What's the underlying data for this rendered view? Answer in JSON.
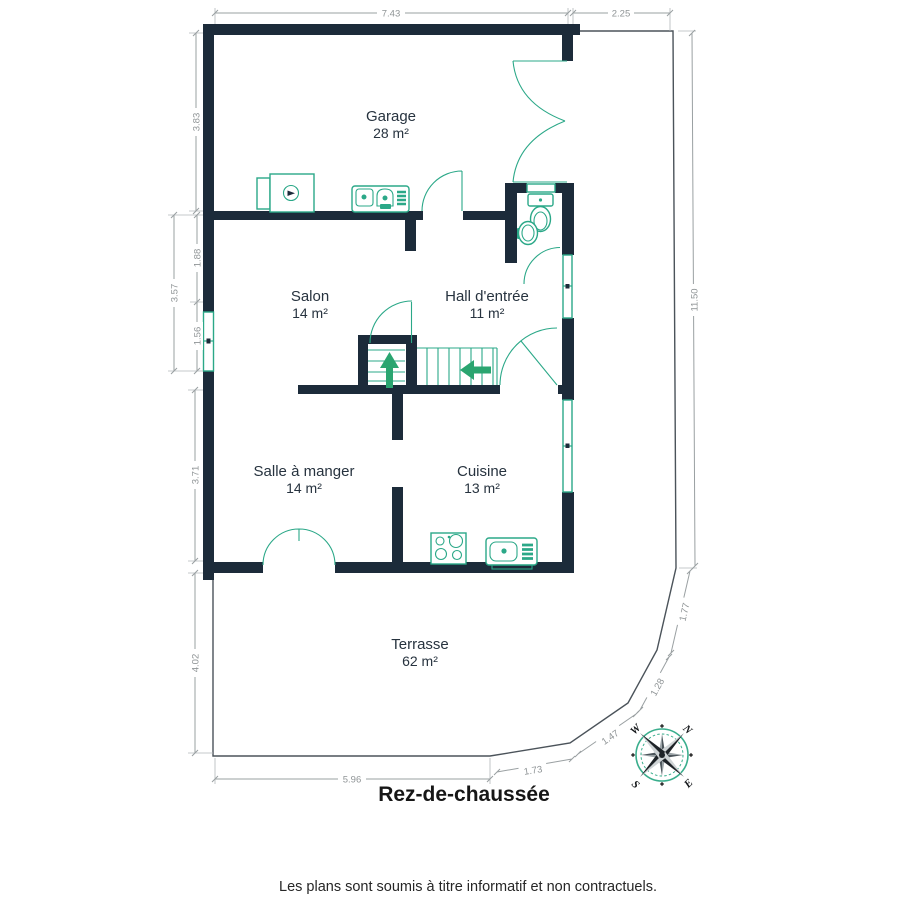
{
  "plan": {
    "title": "Rez-de-chaussée",
    "footer": "Les plans sont soumis à titre informatif et non contractuels.",
    "rooms": [
      {
        "name": "Garage",
        "area": "28 m²"
      },
      {
        "name": "Salon",
        "area": "14 m²"
      },
      {
        "name": "Hall d'entrée",
        "area": "11 m²"
      },
      {
        "name": "Salle à manger",
        "area": "14 m²"
      },
      {
        "name": "Cuisine",
        "area": "13 m²"
      },
      {
        "name": "Terrasse",
        "area": "62 m²"
      }
    ],
    "dimensions": {
      "top_width": "7.43",
      "top_right": "2.25",
      "left_garage": "3.83",
      "left_salon_total": "3.57",
      "left_salon_upper": "1.88",
      "left_salon_window": "1.56",
      "left_dining": "3.71",
      "left_terrace": "4.02",
      "right_side": "11.50",
      "bottom": "5.96",
      "terrace_seg_a": "1.73",
      "terrace_seg_b": "1.47",
      "terrace_seg_c": "1.28",
      "terrace_seg_d": "1.77"
    },
    "compass": {
      "n": "N",
      "e": "E",
      "s": "S",
      "w": "W"
    },
    "colors": {
      "wall": "#1c2b3a",
      "fixture_teal": "#2ba888",
      "dimension_gray": "#9aa0a2",
      "boundary_gray": "#4b535a"
    }
  }
}
